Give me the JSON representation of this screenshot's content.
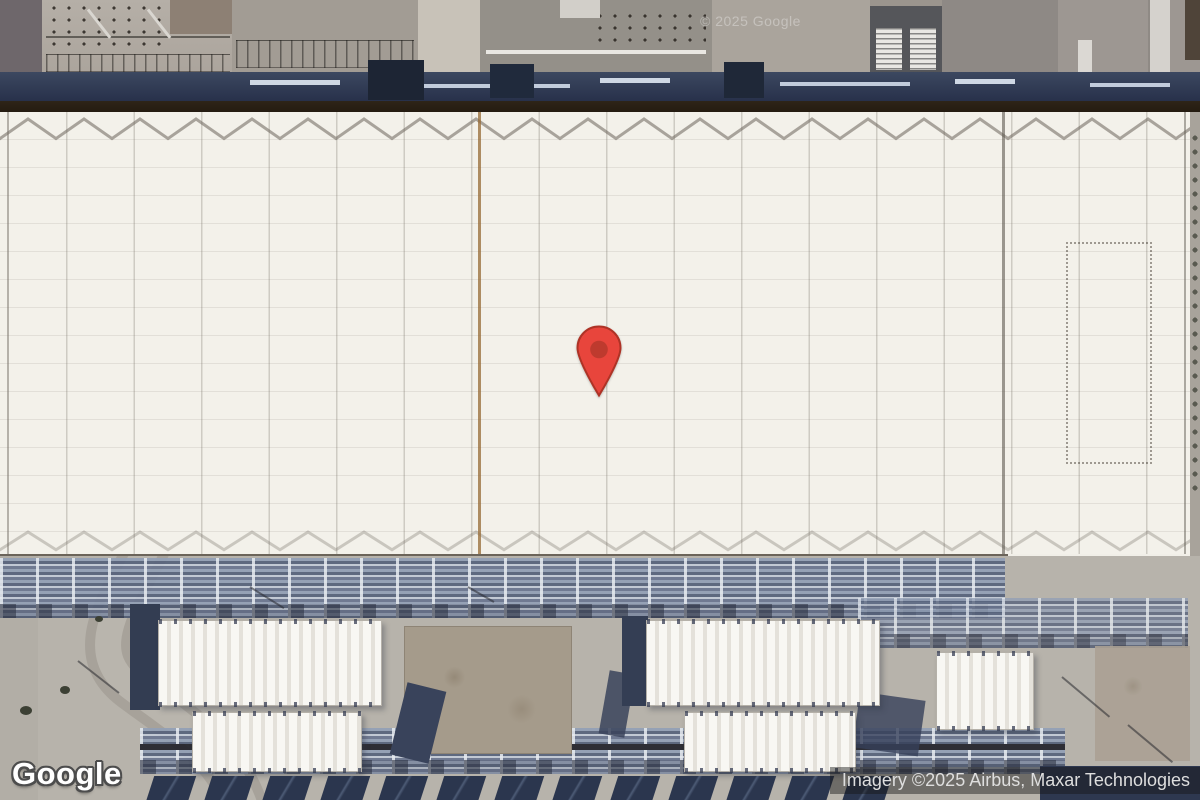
{
  "map": {
    "logo_text": "Google",
    "attribution": "Imagery ©2025 Airbus, Maxar Technologies",
    "watermark": "© 2025 Google"
  },
  "theme": {
    "pin_red": "#E8453C",
    "pin_dot": "#BE3A2E",
    "pin_outline": "#AE3326",
    "attribution_bg": "rgba(22,22,22,0.45)",
    "attribution_text": "#DEDEDE",
    "logo_fill": "#FFFFFF",
    "logo_outline": "#4D4D4D"
  }
}
